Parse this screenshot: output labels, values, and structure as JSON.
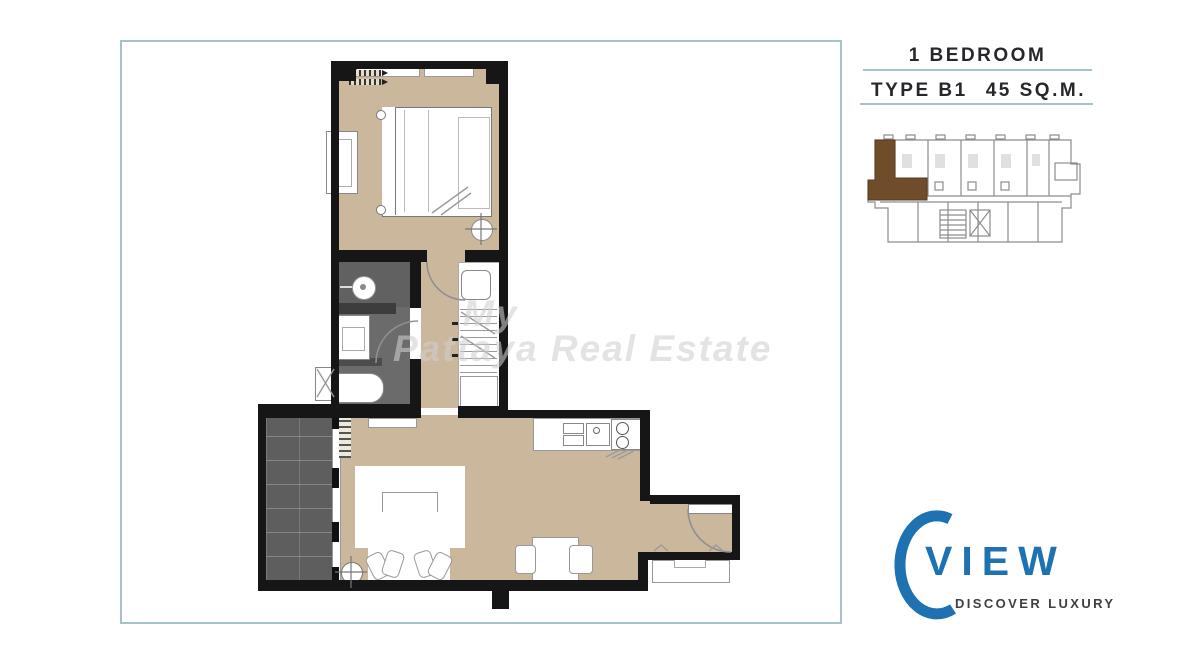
{
  "header": {
    "bedrooms_label": "1 BEDROOM",
    "type_label": "TYPE B1",
    "area_label": "45 SQ.M."
  },
  "logo": {
    "brand": "VIEW",
    "tagline": "DISCOVER LUXURY",
    "mark": "c-arc-icon"
  },
  "watermark": {
    "line1": "My",
    "line2": "Pattaya Real Estate"
  },
  "plan": {
    "rooms": [
      "bedroom",
      "bathroom",
      "corridor",
      "kitchen",
      "living-dining",
      "entry-hall",
      "balcony"
    ],
    "symbols": [
      "double-bed",
      "wardrobe-shelves",
      "ceiling-light-icon",
      "ac-coil-icon",
      "window",
      "shower-head-icon",
      "washbasin",
      "bathtub",
      "washer-icon",
      "kitchen-sink",
      "cooktop",
      "dining-table",
      "dining-chair",
      "sofa",
      "armchair-pair",
      "rug",
      "sliding-door",
      "door-swing-arc",
      "entry-door",
      "console"
    ]
  },
  "keyplan": {
    "description": "building-key-plan",
    "highlight": "unit-left-end"
  },
  "colors": {
    "floor_tan": "#cbb79c",
    "wall_black": "#161616",
    "bath_gray": "#6b6b6b",
    "balcony_gray": "#5e5e5e",
    "frame_teal": "#a7c2c9",
    "brand_blue": "#1e72b1",
    "keyplan_unit_brown": "#6f4c2a",
    "text_dark": "#26272b"
  }
}
